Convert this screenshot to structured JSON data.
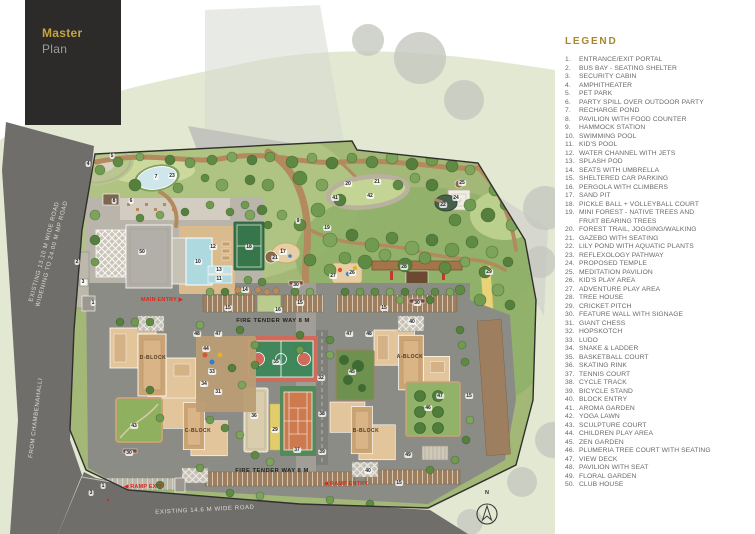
{
  "header": {
    "title_line1": "Master",
    "title_line2": "Plan"
  },
  "legend": {
    "title": "LEGEND",
    "items": [
      "ENTRANCE/EXIT PORTAL",
      "BUS BAY - SEATING SHELTER",
      "SECURITY CABIN",
      "AMPHITHEATER",
      "PET PARK",
      "PARTY SPILL OVER OUTDOOR PARTY",
      "RECHARGE POND",
      "PAVILION WITH FOOD COUNTER",
      "HAMMOCK STATION",
      "SWIMMING POOL",
      "KID'S POOL",
      "WATER CHANNEL WITH JETS",
      "SPLASH POD",
      "SEATS WITH UMBRELLA",
      "SHELTERED CAR PARKING",
      "PERGOLA WITH CLIMBERS",
      "SAND PIT",
      "PICKLE BALL + VOLLEYBALL COURT",
      "MINI FOREST - NATIVE TREES AND\nFRUIT BEARING TREES",
      "FOREST TRAIL, JOGGING/WALKING",
      "GAZEBO WITH SEATING",
      "LILY POND WITH AQUATIC PLANTS",
      "REFLEXOLOGY PATHWAY",
      "PROPOSED TEMPLE",
      "MEDITATION PAVILION",
      "KID'S PLAY AREA",
      "ADVENTURE PLAY AREA",
      "TREE HOUSE",
      "CRICKET PITCH",
      "FEATURE WALL WITH SIGNAGE",
      "GIANT CHESS",
      "HOPSKOTCH",
      "LUDO",
      "SNAKE & LADDER",
      "BASKETBALL COURT",
      "SKATING RINK",
      "TENNIS COURT",
      "CYCLE TRACK",
      "BICYCLE STAND",
      "BLOCK ENTRY",
      "AROMA GARDEN",
      "YOGA LAWN",
      "SCULPTURE COURT",
      "CHILDREN PLAY AREA",
      "ZEN GARDEN",
      "PLUMERIA TREE COURT WITH SEATING",
      "VIEW DECK",
      "PAVILION WITH SEAT",
      "FLORAL GARDEN",
      "CLUB HOUSE"
    ]
  },
  "map": {
    "road_labels": [
      {
        "text": "EXISTING 13.10 M WIDE ROAD\nWIDENING TO 24.00 M MP ROAD",
        "x": 49,
        "y": 253,
        "rot": -75
      },
      {
        "text": "FROM CHAMBENAHALLI",
        "x": 37,
        "y": 418,
        "rot": -83
      },
      {
        "text": "EXISTING 14.6 M WIDE ROAD",
        "x": 205,
        "y": 511,
        "rot": -3
      }
    ],
    "way_labels": [
      {
        "text": "FIRE TENDER WAY 8 M",
        "x": 273,
        "y": 321
      },
      {
        "text": "FIRE TENDER WAY 8 M",
        "x": 272,
        "y": 471
      }
    ],
    "entry_labels": [
      {
        "text": "MAIN ENTRY ▶",
        "x": 162,
        "y": 300
      },
      {
        "text": "◀ RAMP EXIT",
        "x": 143,
        "y": 487
      },
      {
        "text": "◀ RAMP ENTRY",
        "x": 346,
        "y": 484
      },
      {
        "text": "▼",
        "x": 108,
        "y": 501
      }
    ],
    "block_labels": [
      {
        "text": "D-BLOCK",
        "x": 153,
        "y": 358
      },
      {
        "text": "A-BLOCK",
        "x": 410,
        "y": 357
      },
      {
        "text": "C-BLOCK",
        "x": 198,
        "y": 431
      },
      {
        "text": "B-BLOCK",
        "x": 366,
        "y": 431
      }
    ],
    "number_labels": [
      {
        "n": "1",
        "x": 93,
        "y": 303
      },
      {
        "n": "1",
        "x": 103,
        "y": 486
      },
      {
        "n": "2",
        "x": 77,
        "y": 262
      },
      {
        "n": "3",
        "x": 83,
        "y": 282
      },
      {
        "n": "3",
        "x": 91,
        "y": 493
      },
      {
        "n": "4",
        "x": 88,
        "y": 164
      },
      {
        "n": "5",
        "x": 112,
        "y": 156
      },
      {
        "n": "6",
        "x": 131,
        "y": 201
      },
      {
        "n": "7",
        "x": 156,
        "y": 177
      },
      {
        "n": "8",
        "x": 114,
        "y": 201
      },
      {
        "n": "9",
        "x": 298,
        "y": 221
      },
      {
        "n": "10",
        "x": 198,
        "y": 262
      },
      {
        "n": "11",
        "x": 219,
        "y": 279
      },
      {
        "n": "12",
        "x": 213,
        "y": 247
      },
      {
        "n": "13",
        "x": 219,
        "y": 270
      },
      {
        "n": "14",
        "x": 245,
        "y": 290
      },
      {
        "n": "15",
        "x": 228,
        "y": 308
      },
      {
        "n": "15",
        "x": 300,
        "y": 303
      },
      {
        "n": "15",
        "x": 384,
        "y": 308
      },
      {
        "n": "15",
        "x": 469,
        "y": 396
      },
      {
        "n": "15",
        "x": 399,
        "y": 483
      },
      {
        "n": "16",
        "x": 278,
        "y": 310
      },
      {
        "n": "17",
        "x": 283,
        "y": 252
      },
      {
        "n": "18",
        "x": 249,
        "y": 247
      },
      {
        "n": "19",
        "x": 327,
        "y": 228
      },
      {
        "n": "20",
        "x": 348,
        "y": 184
      },
      {
        "n": "21",
        "x": 275,
        "y": 258
      },
      {
        "n": "21",
        "x": 377,
        "y": 182
      },
      {
        "n": "22",
        "x": 443,
        "y": 205
      },
      {
        "n": "23",
        "x": 172,
        "y": 176
      },
      {
        "n": "24",
        "x": 456,
        "y": 198
      },
      {
        "n": "25",
        "x": 462,
        "y": 183
      },
      {
        "n": "26",
        "x": 352,
        "y": 273
      },
      {
        "n": "27",
        "x": 333,
        "y": 276
      },
      {
        "n": "28",
        "x": 404,
        "y": 267
      },
      {
        "n": "29",
        "x": 275,
        "y": 430
      },
      {
        "n": "29",
        "x": 489,
        "y": 272
      },
      {
        "n": "30",
        "x": 296,
        "y": 285
      },
      {
        "n": "30",
        "x": 417,
        "y": 303
      },
      {
        "n": "30",
        "x": 129,
        "y": 453
      },
      {
        "n": "31",
        "x": 218,
        "y": 392
      },
      {
        "n": "32",
        "x": 321,
        "y": 378
      },
      {
        "n": "33",
        "x": 212,
        "y": 372
      },
      {
        "n": "34",
        "x": 204,
        "y": 384
      },
      {
        "n": "35",
        "x": 276,
        "y": 362
      },
      {
        "n": "36",
        "x": 254,
        "y": 416
      },
      {
        "n": "37",
        "x": 297,
        "y": 450
      },
      {
        "n": "38",
        "x": 322,
        "y": 414
      },
      {
        "n": "39",
        "x": 322,
        "y": 452
      },
      {
        "n": "40",
        "x": 412,
        "y": 322
      },
      {
        "n": "40",
        "x": 368,
        "y": 471
      },
      {
        "n": "41",
        "x": 335,
        "y": 198
      },
      {
        "n": "42",
        "x": 370,
        "y": 196
      },
      {
        "n": "43",
        "x": 134,
        "y": 426
      },
      {
        "n": "44",
        "x": 206,
        "y": 349
      },
      {
        "n": "45",
        "x": 352,
        "y": 372
      },
      {
        "n": "46",
        "x": 428,
        "y": 408
      },
      {
        "n": "47",
        "x": 218,
        "y": 334
      },
      {
        "n": "47",
        "x": 349,
        "y": 334
      },
      {
        "n": "47",
        "x": 440,
        "y": 396
      },
      {
        "n": "48",
        "x": 197,
        "y": 334
      },
      {
        "n": "48",
        "x": 369,
        "y": 334
      },
      {
        "n": "49",
        "x": 408,
        "y": 455
      },
      {
        "n": "50",
        "x": 142,
        "y": 252
      }
    ],
    "compass": "N"
  },
  "colors": {
    "brand_dark": "#2d2b29",
    "brand_gold": "#c6a43c",
    "legend_gold": "#a8862d",
    "road_gray": "#6f6e6a",
    "site_green": "#a3b877",
    "path_brown": "#b28a5e",
    "building_tan": "#e2c59b",
    "pool_blue": "#aed9df",
    "court_green": "#41875c",
    "court_red": "#d06a5a",
    "tennis_orange": "#cd7a4e",
    "cricket_yellow": "#e3cc6c",
    "annotation_red": "#e02617"
  }
}
